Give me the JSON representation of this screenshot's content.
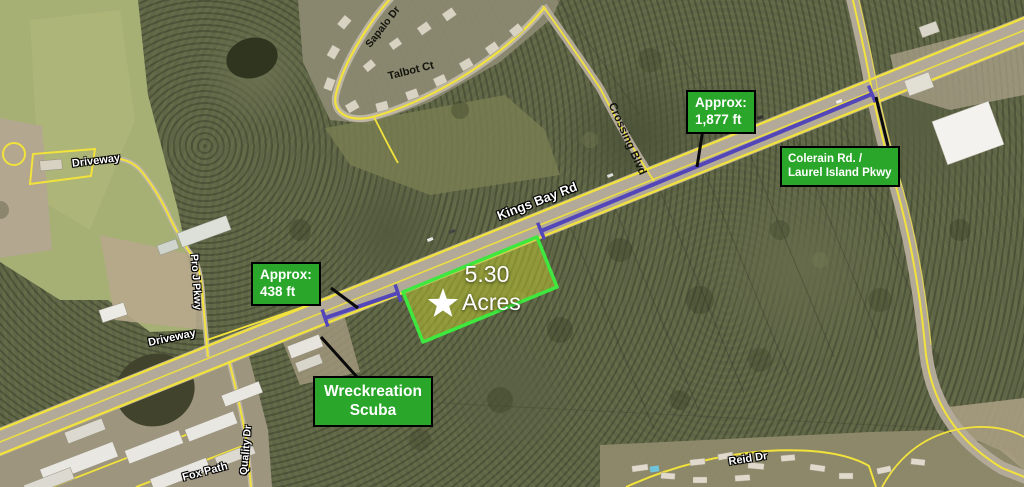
{
  "map": {
    "parcel": {
      "size": "5.30",
      "unit": "Acres"
    },
    "callouts": {
      "approx_1877": {
        "line1": "Approx:",
        "line2": "1,877 ft"
      },
      "colerain": {
        "line1": "Colerain Rd. /",
        "line2": "Laurel Island Pkwy"
      },
      "approx_438": {
        "line1": "Approx:",
        "line2": "438 ft"
      },
      "wreckreation": {
        "line1": "Wreckreation",
        "line2": "Scuba"
      }
    },
    "road_labels": {
      "kings_bay_rd": "Kings Bay Rd",
      "crossing_blvd": "Crossing Blvd",
      "sapalo_dr": "Sapalo Dr",
      "talbot_ct": "Talbot Ct",
      "driveway_nw": "Driveway",
      "pro_j_pkwy": "Pro J Pkwy",
      "driveway_w": "Driveway",
      "quality_dr": "Quality Dr",
      "fox_path": "Fox Path",
      "reid_dr": "Reid Dr"
    },
    "colors": {
      "callout_green": "#2aa62a",
      "parcel_outline": "#3ee83e",
      "parcel_fill": "rgba(205,215,45,0.45)",
      "measure_purple": "#5246b8",
      "road_yellow": "#f2e23c"
    }
  }
}
